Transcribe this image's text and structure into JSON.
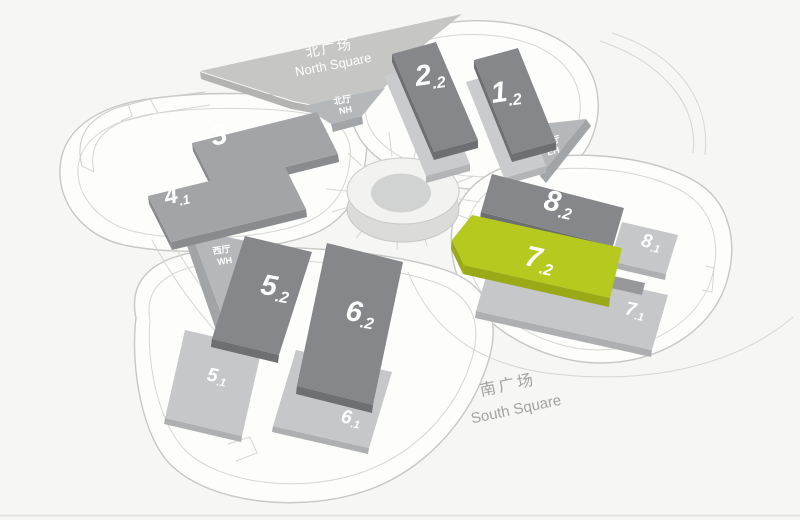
{
  "colors": {
    "background": "#f6f6f4",
    "highlight": "#b5c91e",
    "hall_dark": "#85878a",
    "hall_medium": "#a2a4a6",
    "hall_light": "#c5c7c9",
    "corner_hall": "#b5b8ba",
    "plaza": "#c6c7c5",
    "ring_top": "#f2f2f0"
  },
  "map": {
    "highlighted_hall": "7.2",
    "squares": {
      "north": {
        "zh": "北广场",
        "en": "North Square"
      },
      "south": {
        "zh": "南广场",
        "en": "South Square"
      }
    },
    "corner_halls": {
      "north": {
        "zh": "北厅",
        "en": "NH"
      },
      "east": {
        "zh": "东厅",
        "en": "EH"
      },
      "west": {
        "zh": "西厅",
        "en": "WH"
      }
    },
    "halls": {
      "h2_2": {
        "num": "2",
        "sub": ".2"
      },
      "h1_2": {
        "num": "1",
        "sub": ".2"
      },
      "h3": {
        "num": "3",
        "sub": ""
      },
      "h4_1": {
        "num": "4",
        "sub": ".1"
      },
      "h5_2": {
        "num": "5",
        "sub": ".2"
      },
      "h6_2": {
        "num": "6",
        "sub": ".2"
      },
      "h5_1": {
        "num": "5",
        "sub": ".1"
      },
      "h6_1": {
        "num": "6",
        "sub": ".1"
      },
      "h8_2": {
        "num": "8",
        "sub": ".2"
      },
      "h7_2": {
        "num": "7",
        "sub": ".2"
      },
      "h8_1": {
        "num": "8",
        "sub": ".1"
      },
      "h7_1": {
        "num": "7",
        "sub": ".1"
      }
    }
  }
}
